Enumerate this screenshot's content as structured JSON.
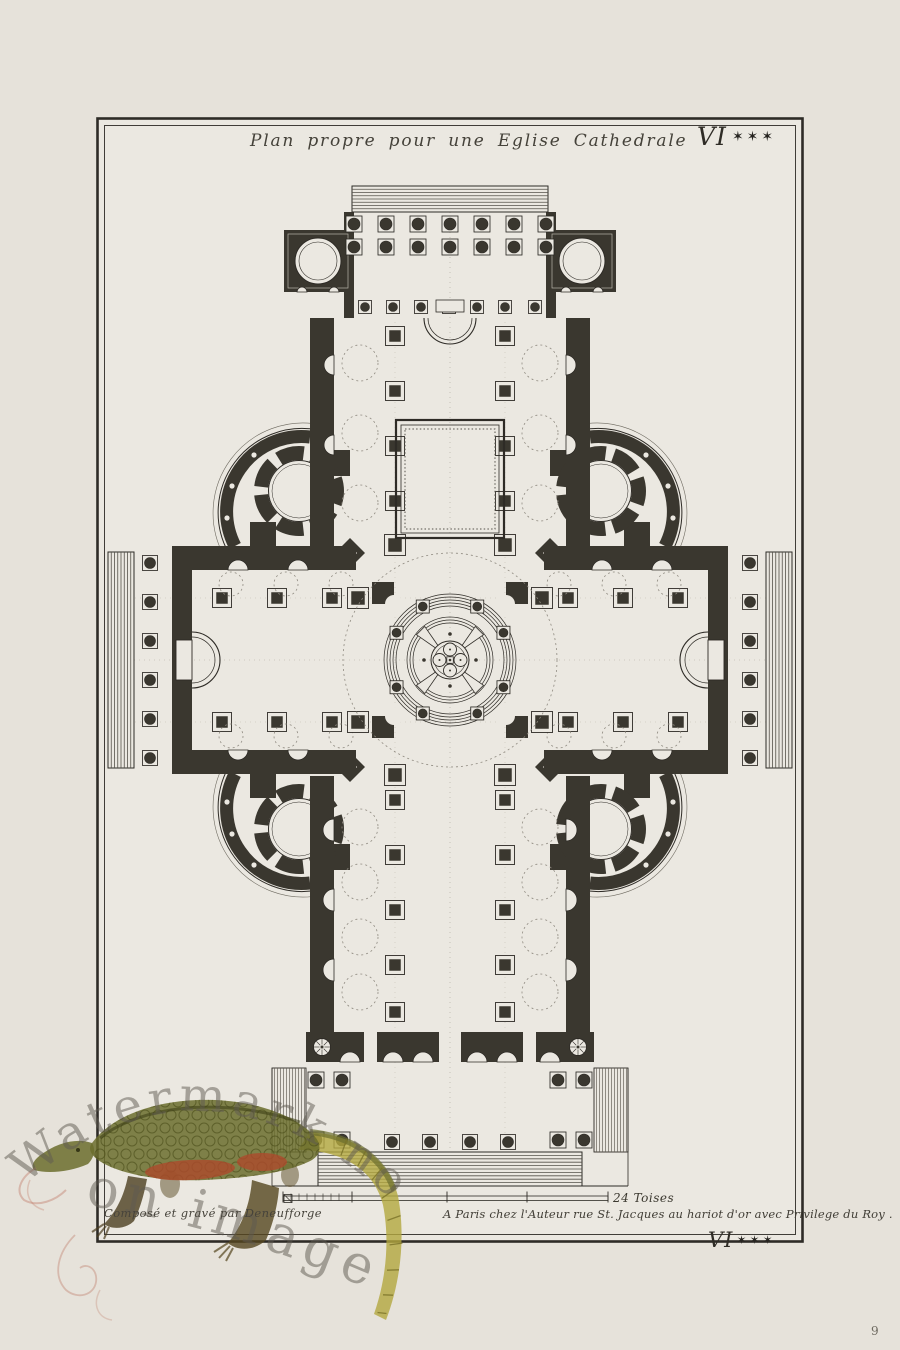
{
  "plate": {
    "title": "Plan propre pour une Eglise Cathedrale",
    "plate_number_top": {
      "numeral": "VI",
      "stars": "✶✶✶"
    },
    "plate_number_bottom": {
      "numeral": "VI",
      "stars": "✶✶✶"
    },
    "credit_left": "Composé et gravé par Deneufforge",
    "imprint_right": "A Paris chez l'Auteur rue St. Jacques au hariot d'or avec Privilege du Roy .",
    "scale_label": "24 Toises"
  },
  "watermark": {
    "line1": "Watermark not",
    "line2": "on image",
    "figure": "crocodile-illustration"
  },
  "page": {
    "number": "9"
  },
  "colors": {
    "paper": "#e6e2da",
    "plate_paper": "#ebe8e1",
    "ink": "#2e2b26",
    "wall": "#3a372f",
    "light_line": "#55524a",
    "dashed": "#8f8a80",
    "watermark_text": "#5f5a51",
    "croc_green": "#6b6d2d",
    "croc_dark_green": "#4d4f1c",
    "croc_red": "#ad4a2c",
    "croc_yellow": "#b3a83f",
    "croc_brown": "#4c3e20"
  }
}
